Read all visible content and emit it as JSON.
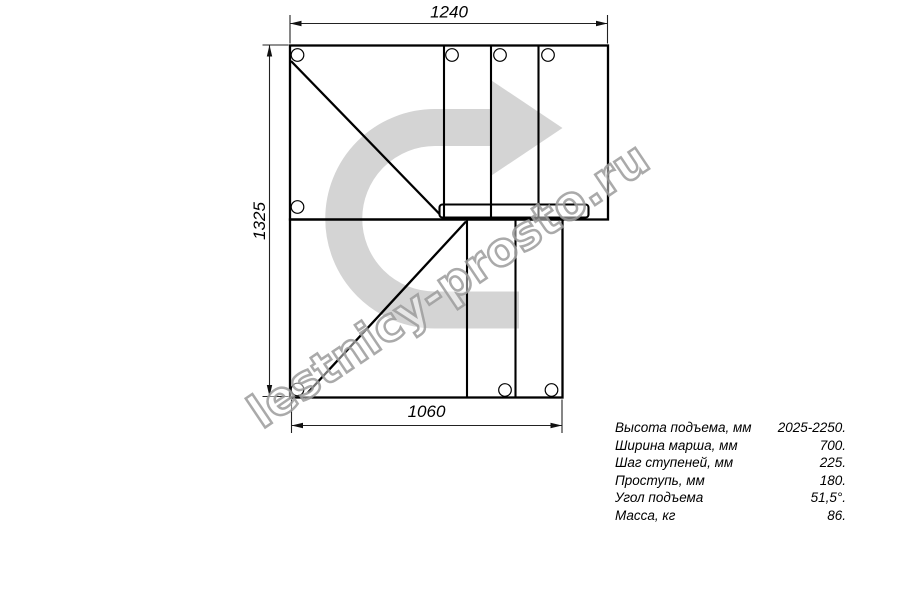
{
  "drawing": {
    "watermark_text": "lestnicy-prosto.ru",
    "dimensions": {
      "top": "1240",
      "left": "1325",
      "bottom": "1060"
    },
    "colors": {
      "line": "#000000",
      "dimension": "#222222",
      "arrow": "#d4d4d4",
      "watermark_outline": "#9b9b9b"
    }
  },
  "specs": {
    "rows": [
      {
        "label": "Высота подъема, мм",
        "value": "2025-2250."
      },
      {
        "label": "Ширина марша, мм",
        "value": "700."
      },
      {
        "label": "Шаг ступеней, мм",
        "value": "225."
      },
      {
        "label": "Проступь, мм",
        "value": "180."
      },
      {
        "label": "Угол подъема",
        "value": "51,5°."
      },
      {
        "label": "Масса, кг",
        "value": "86."
      }
    ]
  }
}
